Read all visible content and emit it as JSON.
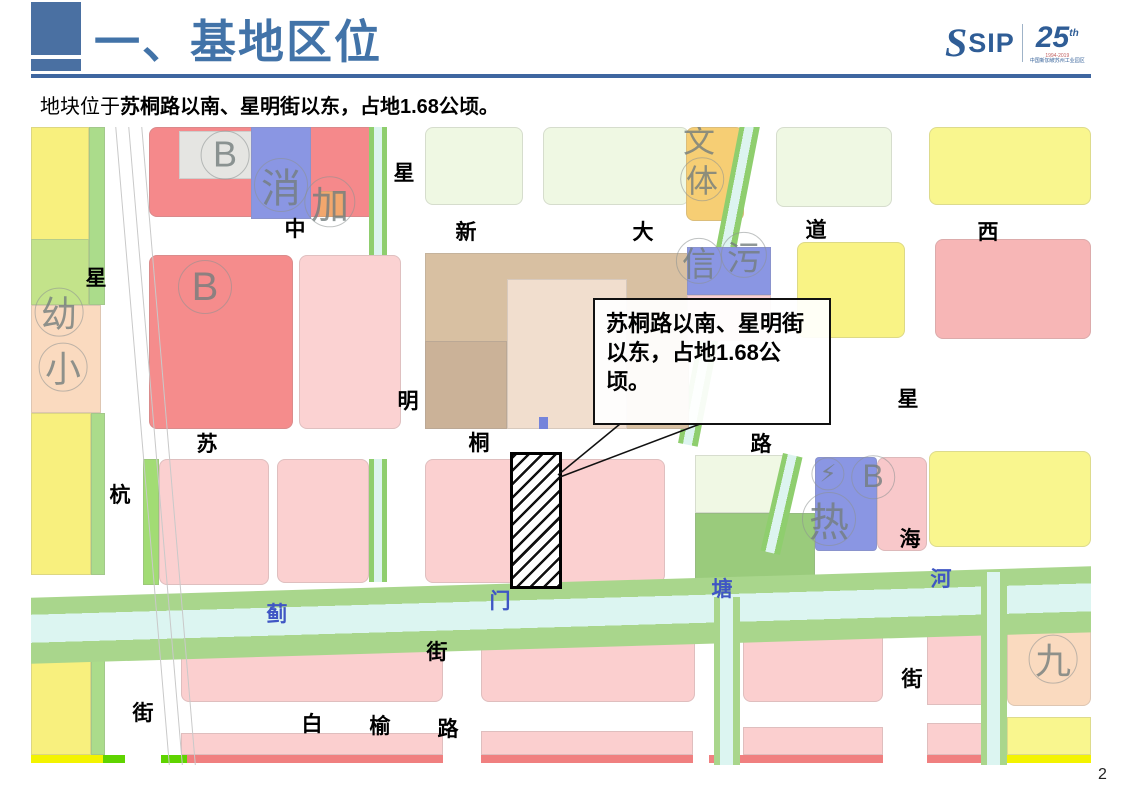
{
  "header": {
    "title": "一、基地区位",
    "logo": {
      "sip_s": "S",
      "sip": "SIP",
      "anniversary": "25",
      "anniversary_sup": "th",
      "anniversary_years": "1994-2019",
      "anniversary_org": "中国新加坡苏州工业园区"
    }
  },
  "subtitle": {
    "prefix": "地块位于",
    "emphasis": "苏桐路以南、星明街以东，占地1.68公顷。"
  },
  "map": {
    "callout": {
      "text": "苏桐路以南、星明街以东，占地1.68公顷。"
    },
    "road_labels": [
      {
        "text": "中",
        "x": 264,
        "y": 101
      },
      {
        "text": "新",
        "x": 435,
        "y": 104
      },
      {
        "text": "大",
        "x": 612,
        "y": 104
      },
      {
        "text": "道",
        "x": 785,
        "y": 102
      },
      {
        "text": "西",
        "x": 957,
        "y": 104
      },
      {
        "text": "星",
        "x": 65,
        "y": 150
      },
      {
        "text": "杭",
        "x": 89,
        "y": 367
      },
      {
        "text": "街",
        "x": 112,
        "y": 585
      },
      {
        "text": "星",
        "x": 373,
        "y": 45
      },
      {
        "text": "明",
        "x": 377,
        "y": 273
      },
      {
        "text": "街",
        "x": 406,
        "y": 524
      },
      {
        "text": "苏",
        "x": 176,
        "y": 316
      },
      {
        "text": "桐",
        "x": 448,
        "y": 315
      },
      {
        "text": "路",
        "x": 730,
        "y": 316
      },
      {
        "text": "星",
        "x": 877,
        "y": 271
      },
      {
        "text": "海",
        "x": 879,
        "y": 411
      },
      {
        "text": "街",
        "x": 881,
        "y": 551
      },
      {
        "text": "白",
        "x": 281,
        "y": 596
      },
      {
        "text": "榆",
        "x": 349,
        "y": 598
      },
      {
        "text": "路",
        "x": 417,
        "y": 601
      }
    ],
    "water_labels": [
      {
        "text": "蓟",
        "x": 246,
        "y": 486
      },
      {
        "text": "门",
        "x": 469,
        "y": 473
      },
      {
        "text": "塘",
        "x": 691,
        "y": 461
      },
      {
        "text": "河",
        "x": 910,
        "y": 451
      }
    ],
    "facility_labels": [
      {
        "text": "B",
        "x": 194,
        "y": 28,
        "size": 36,
        "circle": true
      },
      {
        "text": "B",
        "x": 174,
        "y": 160,
        "size": 40,
        "circle": true
      },
      {
        "text": "B",
        "x": 842,
        "y": 350,
        "size": 32,
        "circle": true
      },
      {
        "text": "消",
        "x": 250,
        "y": 58,
        "size": 40,
        "circle": true
      },
      {
        "text": "加",
        "x": 299,
        "y": 75,
        "size": 38,
        "circle": true
      },
      {
        "text": "幼",
        "x": 28,
        "y": 185,
        "size": 36,
        "circle": true
      },
      {
        "text": "小",
        "x": 32,
        "y": 240,
        "size": 36,
        "circle": true
      },
      {
        "text": "文",
        "x": 668,
        "y": 12,
        "size": 32,
        "circle": false
      },
      {
        "text": "体",
        "x": 671,
        "y": 52,
        "size": 32,
        "circle": true
      },
      {
        "text": "信",
        "x": 668,
        "y": 134,
        "size": 34,
        "circle": true
      },
      {
        "text": "污",
        "x": 713,
        "y": 128,
        "size": 34,
        "circle": true
      },
      {
        "text": "热",
        "x": 798,
        "y": 392,
        "size": 40,
        "circle": true
      },
      {
        "text": "⚡",
        "x": 797,
        "y": 347,
        "size": 24,
        "circle": true
      },
      {
        "text": "九",
        "x": 1022,
        "y": 532,
        "size": 36,
        "circle": true
      }
    ]
  },
  "page_number": "2",
  "colors": {
    "accent_blue": "#4A70A2",
    "title_blue": "#4273A8",
    "residential_pink": "#FBD0D0",
    "commercial_red": "#F5898B",
    "yellow_parcel": "#F9F68E",
    "green_parcel": "#9ACB7C",
    "pale_green_parcel": "#EFF8E3",
    "tan_parcel": "#D8C0A2",
    "utility_blue": "#8A96E3",
    "amber_parcel": "#F6CE74",
    "water_cyan": "#DCF5F1",
    "bank_green": "#A9D68C"
  }
}
